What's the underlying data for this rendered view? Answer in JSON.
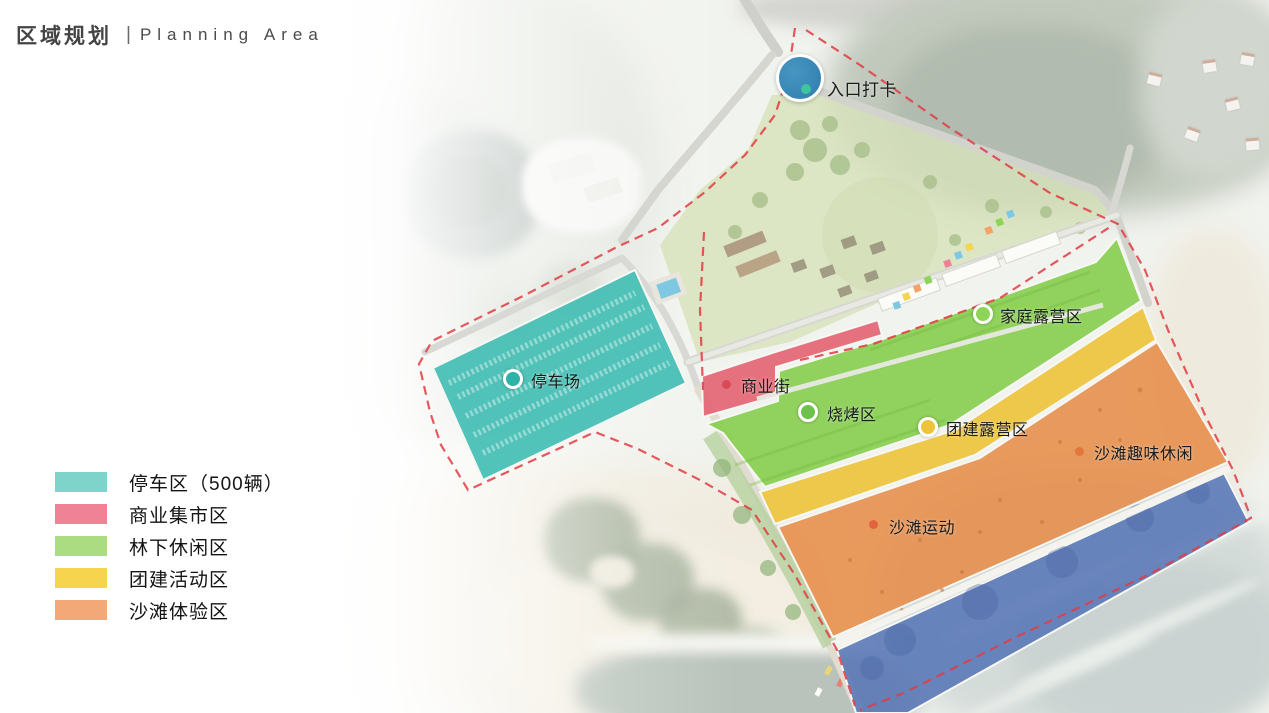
{
  "header": {
    "title_zh": "区域规划",
    "separator": "|",
    "title_en": "Planning Area"
  },
  "legend": {
    "items": [
      {
        "label": "停车区（500辆）",
        "color": "#7ed3cb"
      },
      {
        "label": "商业集市区",
        "color": "#ef8294"
      },
      {
        "label": "林下休闲区",
        "color": "#abdc82"
      },
      {
        "label": "团建活动区",
        "color": "#f6d44e"
      },
      {
        "label": "沙滩体验区",
        "color": "#f2a877"
      }
    ]
  },
  "map": {
    "boundary_color": "#e23c43",
    "markers": [
      {
        "id": "entrance",
        "label": "入口打卡",
        "type": "entrance-circle",
        "color": "#3a88b8"
      },
      {
        "id": "parking",
        "label": "停车场",
        "type": "ring",
        "color": "#2fb3a8"
      },
      {
        "id": "commercial",
        "label": "商业街",
        "type": "dot",
        "color": "#d94a58"
      },
      {
        "id": "bbq",
        "label": "烧烤区",
        "type": "ring",
        "color": "#6cc24a"
      },
      {
        "id": "family-camp",
        "label": "家庭露营区",
        "type": "ring",
        "color": "#8ed457"
      },
      {
        "id": "team-camp",
        "label": "团建露营区",
        "type": "ring",
        "color": "#edc33a"
      },
      {
        "id": "beach-fun",
        "label": "沙滩趣味休闲",
        "type": "dot",
        "color": "#e2763c"
      },
      {
        "id": "beach-sport",
        "label": "沙滩运动",
        "type": "dot",
        "color": "#e2633c"
      }
    ],
    "zones": [
      {
        "id": "parking-zone",
        "color": "#3fbdb2"
      },
      {
        "id": "commercial-zone",
        "color": "#e45f6e"
      },
      {
        "id": "forest-leisure-zone",
        "color": "#85ce4d"
      },
      {
        "id": "team-activity-zone",
        "color": "#ecc338"
      },
      {
        "id": "beach-experience-zone",
        "color": "#e78f4d"
      },
      {
        "id": "water-zone",
        "color": "#5876b6"
      }
    ]
  }
}
